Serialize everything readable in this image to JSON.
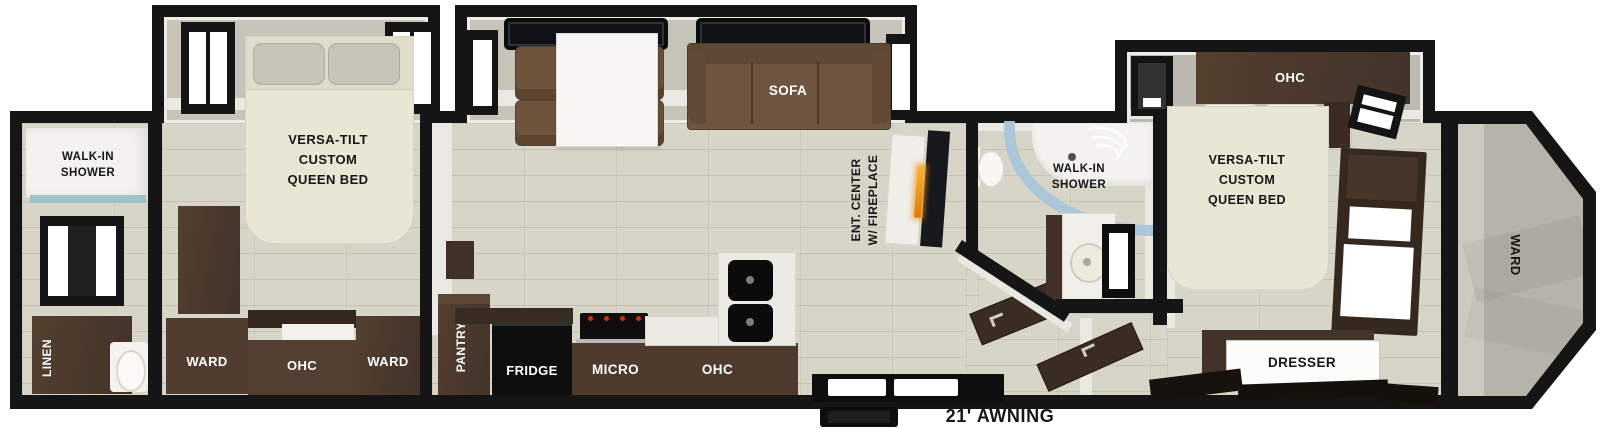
{
  "plan": {
    "awning_label": "21' AWNING",
    "rear_bathroom": {
      "shower_line1": "WALK-IN",
      "shower_line2": "SHOWER",
      "linen": "LINEN"
    },
    "rear_bedroom": {
      "bed_line1": "VERSA-TILT",
      "bed_line2": "CUSTOM",
      "bed_line3": "QUEEN BED",
      "ward_left": "WARD",
      "ohc": "OHC",
      "ward_right": "WARD"
    },
    "living": {
      "sofa": "SOFA",
      "ent_line1": "ENT. CENTER",
      "ent_line2": "W/ FIREPLACE"
    },
    "kitchen": {
      "pantry": "PANTRY",
      "fridge": "FRIDGE",
      "micro": "MICRO",
      "ohc": "OHC"
    },
    "mid_bathroom": {
      "shower_line1": "WALK-IN",
      "shower_line2": "SHOWER"
    },
    "front_bedroom": {
      "ohc": "OHC",
      "bed_line1": "VERSA-TILT",
      "bed_line2": "CUSTOM",
      "bed_line3": "QUEEN BED",
      "dresser": "DRESSER",
      "ward": "WARD"
    },
    "colors": {
      "wall_black": "#151515",
      "floor_beige": "#d7d4c8",
      "cabinet_wood": "#4a382c",
      "sofa_brown": "#6e5540",
      "bed_cream": "#e9e6d6",
      "shower_glass_blue": "#a9c7d8",
      "fireplace_glow": "#e8920f"
    }
  }
}
